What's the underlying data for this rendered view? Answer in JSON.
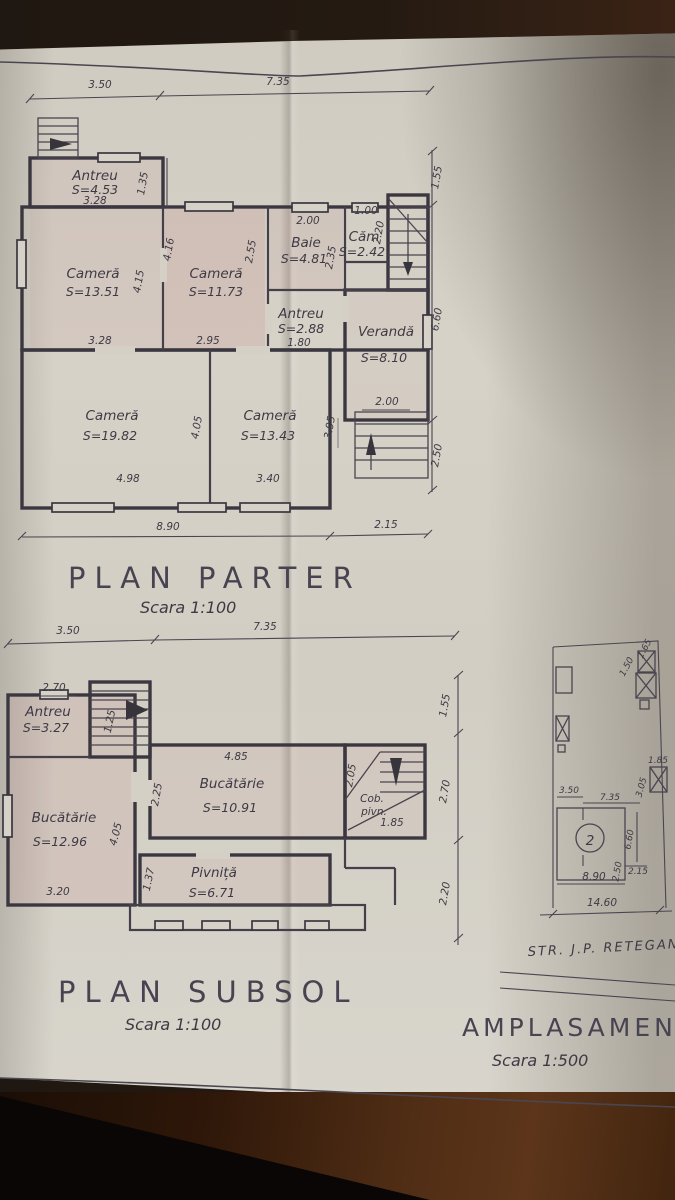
{
  "palette": {
    "backdrop": "#241a12",
    "paper": "#d4d0c6",
    "ink": "#3b3741",
    "pink_tint": "#c08080",
    "wood": "#4e2c14"
  },
  "parter": {
    "title": "PLAN  PARTER",
    "scale": "Scara 1:100",
    "rooms": {
      "antreu1": {
        "name": "Antreu",
        "area": "S=4.53"
      },
      "camera1": {
        "name": "Cameră",
        "area": "S=13.51"
      },
      "camera2": {
        "name": "Cameră",
        "area": "S=11.73"
      },
      "baie": {
        "name": "Baie",
        "area": "S=4.81"
      },
      "cam": {
        "name": "Căm",
        "area": "S=2.42"
      },
      "antreu2": {
        "name": "Antreu",
        "area": "S=2.88"
      },
      "veranda": {
        "name": "Verandă",
        "area": "S=8.10"
      },
      "camera3": {
        "name": "Cameră",
        "area": "S=19.82"
      },
      "camera4": {
        "name": "Cameră",
        "area": "S=13.43"
      }
    },
    "dims": {
      "top_left": "3.50",
      "top_right": "7.35",
      "antreu_width": "3.28",
      "antreu_height": "1.35",
      "camera1_width": "3.28",
      "camera1_height": "4.15",
      "camera2_width": "2.95",
      "camera2_height": "4.16",
      "baie_width": "2.00",
      "baie_height_left": "2.55",
      "baie_height_right": "2.35",
      "cam_width": "1.00",
      "cam_height": "2.20",
      "antreu2_width": "1.80",
      "camera3_width": "4.98",
      "camera3_height": "4.05",
      "camera4_width": "3.40",
      "camera4_height": "3.95",
      "stairs_width": "2.00",
      "right_top": "1.55",
      "right_mid": "6.60",
      "right_bottom": "2.50",
      "bottom_left": "8.90",
      "bottom_right": "2.15"
    }
  },
  "subsol": {
    "title": "PLAN  SUBSOL",
    "scale": "Scara 1:100",
    "rooms": {
      "antreu": {
        "name": "Antreu",
        "area": "S=3.27"
      },
      "bucatarie1": {
        "name": "Bucătărie",
        "area": "S=12.96"
      },
      "bucatarie2": {
        "name": "Bucătărie",
        "area": "S=10.91"
      },
      "pivnita": {
        "name": "Pivniță",
        "area": "S=6.71"
      },
      "cob_pivn": {
        "line1": "Cob.",
        "line2": "pivn.",
        "dim": "1.85"
      }
    },
    "dims": {
      "top_left": "3.50",
      "top_right": "7.35",
      "antreu_width": "2.70",
      "stairs_height": "1.25",
      "bucatarie1_width": "3.20",
      "bucatarie1_height": "4.05",
      "bucatarie2_width": "4.85",
      "bucatarie2_height": "2.25",
      "pivnita_height": "1.37",
      "cob_height": "2.05",
      "right_top": "1.55",
      "right_mid": "2.70",
      "right_bottom": "2.20"
    }
  },
  "amplasament": {
    "title": "AMPLASAMENT",
    "scale": "Scara 1:500",
    "street": "STR. J.P. RETEGAN",
    "house_number": "2",
    "dims": {
      "annex_top1": "1.50",
      "annex_top2": "1.65",
      "annex_right1": "1.85",
      "annex_right2": "3.05",
      "house_top_left": "3.50",
      "house_top_right": "7.35",
      "house_right": "6.60",
      "house_right2": "2.15",
      "house_bottom": "8.90",
      "house_bottom2": "2.50",
      "site_width": "14.60"
    }
  }
}
